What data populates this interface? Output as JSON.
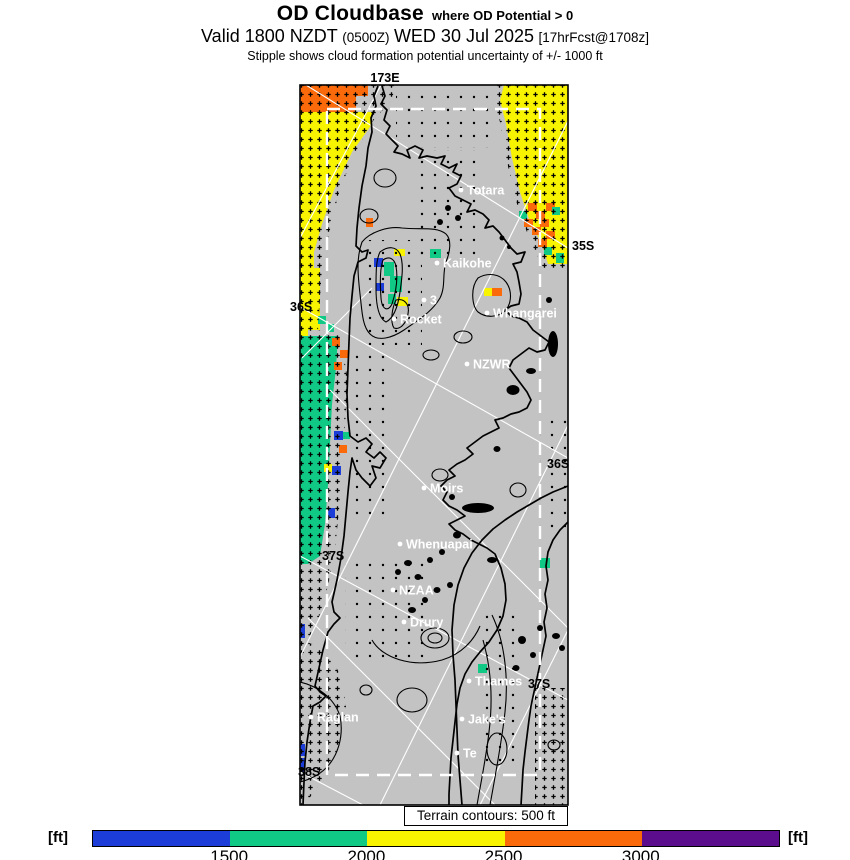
{
  "title": {
    "main": "OD Cloudbase",
    "qualifier": "where OD Potential > 0",
    "valid_part1": "Valid 1800 NZDT",
    "valid_part2": "(0500Z)",
    "valid_part3": "WED 30 Jul 2025",
    "valid_part4": "[17hrFcst@1708z]",
    "stipple_note": "Stipple shows cloud formation potential uncertainty of +/- 1000 ft"
  },
  "map": {
    "terrain_note": "Terrain contours: 500 ft",
    "graticule_labels": [
      {
        "text": "173E",
        "x": 385,
        "y": 82,
        "anchor": "middle"
      },
      {
        "text": "35S",
        "x": 572,
        "y": 250,
        "anchor": "start"
      },
      {
        "text": "36S",
        "x": 290,
        "y": 311,
        "anchor": "start"
      },
      {
        "text": "36S",
        "x": 547,
        "y": 468,
        "anchor": "start"
      },
      {
        "text": "37S",
        "x": 322,
        "y": 560,
        "anchor": "start"
      },
      {
        "text": "37S",
        "x": 528,
        "y": 688,
        "anchor": "start"
      },
      {
        "text": "38S",
        "x": 298,
        "y": 776,
        "anchor": "start"
      }
    ],
    "places": [
      {
        "name": "Totara",
        "x": 461,
        "y": 190
      },
      {
        "name": "Kaikohe",
        "x": 437,
        "y": 263
      },
      {
        "name": "3",
        "x": 424,
        "y": 300
      },
      {
        "name": "Whangarei",
        "x": 487,
        "y": 313
      },
      {
        "name": "Rocket",
        "x": 394,
        "y": 319
      },
      {
        "name": "NZWR",
        "x": 467,
        "y": 364
      },
      {
        "name": "Moirs",
        "x": 424,
        "y": 488
      },
      {
        "name": "Whenuapai",
        "x": 400,
        "y": 544
      },
      {
        "name": "NZAA",
        "x": 393,
        "y": 590
      },
      {
        "name": "Drury",
        "x": 404,
        "y": 622
      },
      {
        "name": "Thames",
        "x": 469,
        "y": 681
      },
      {
        "name": "Raglan",
        "x": 311,
        "y": 717
      },
      {
        "name": "Jake's",
        "x": 462,
        "y": 719
      },
      {
        "name": "Te",
        "x": 457,
        "y": 753
      }
    ]
  },
  "palette": {
    "blue": "#1c3dd8",
    "green": "#10c985",
    "yellow": "#f8f400",
    "orange": "#fb6a0a",
    "purple": "#5c0d8e",
    "map_bg": "#c3c3c3",
    "grid": "#ffffff",
    "coast": "#000000"
  },
  "colorbar": {
    "unit_left": "[ft]",
    "unit_right": "[ft]",
    "segments": [
      "blue",
      "green",
      "yellow",
      "orange",
      "purple"
    ],
    "ticks": [
      {
        "label": "1500",
        "frac": 0.2
      },
      {
        "label": "2000",
        "frac": 0.4
      },
      {
        "label": "2500",
        "frac": 0.6
      },
      {
        "label": "3000",
        "frac": 0.8
      }
    ]
  }
}
